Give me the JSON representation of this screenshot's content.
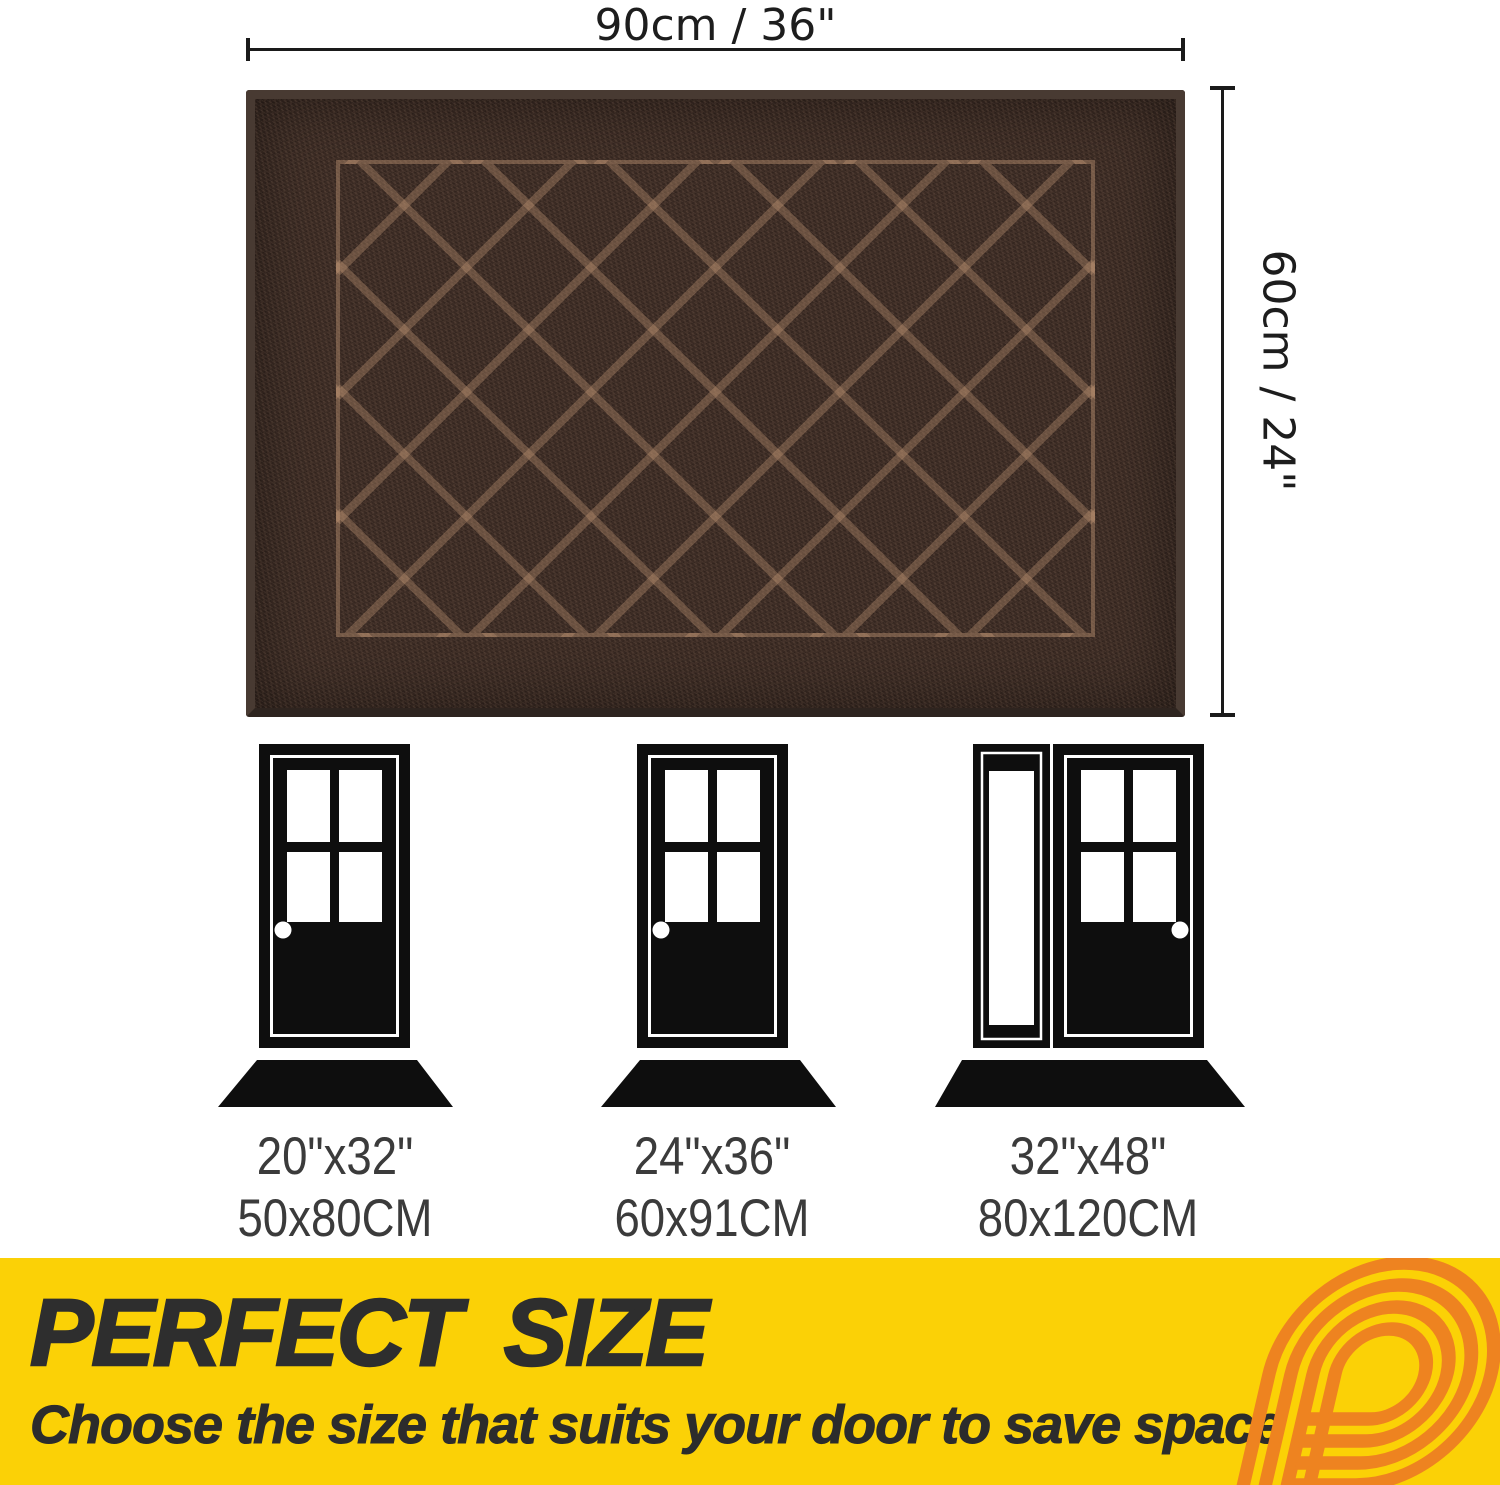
{
  "dimensions": {
    "width_label": "90cm / 36\"",
    "height_label": "60cm / 24\""
  },
  "size_options": [
    {
      "inches": "20\"x32\"",
      "cm": "50x80CM"
    },
    {
      "inches": "24\"x36\"",
      "cm": "60x91CM"
    },
    {
      "inches": "32\"x48\"",
      "cm": "80x120CM"
    }
  ],
  "banner": {
    "title": "PERFECT SIZE",
    "subtitle": "Choose the size that suits your door to save space",
    "background_color": "#FBD106",
    "text_color": "#2E2E2E",
    "logo_color": "#EE8320",
    "logo": "letter-p-stripes-logo"
  },
  "mat": {
    "base_color": "#3A2A23",
    "binding_color": "#483A32",
    "pattern": "diamond-lattice",
    "pattern_line_color": "#C49876"
  },
  "icons": {
    "door1": "single-door-icon",
    "door2": "single-door-icon",
    "door3": "door-with-sidelight-icon",
    "mat_shape": "trapezoid-mat-icon"
  }
}
